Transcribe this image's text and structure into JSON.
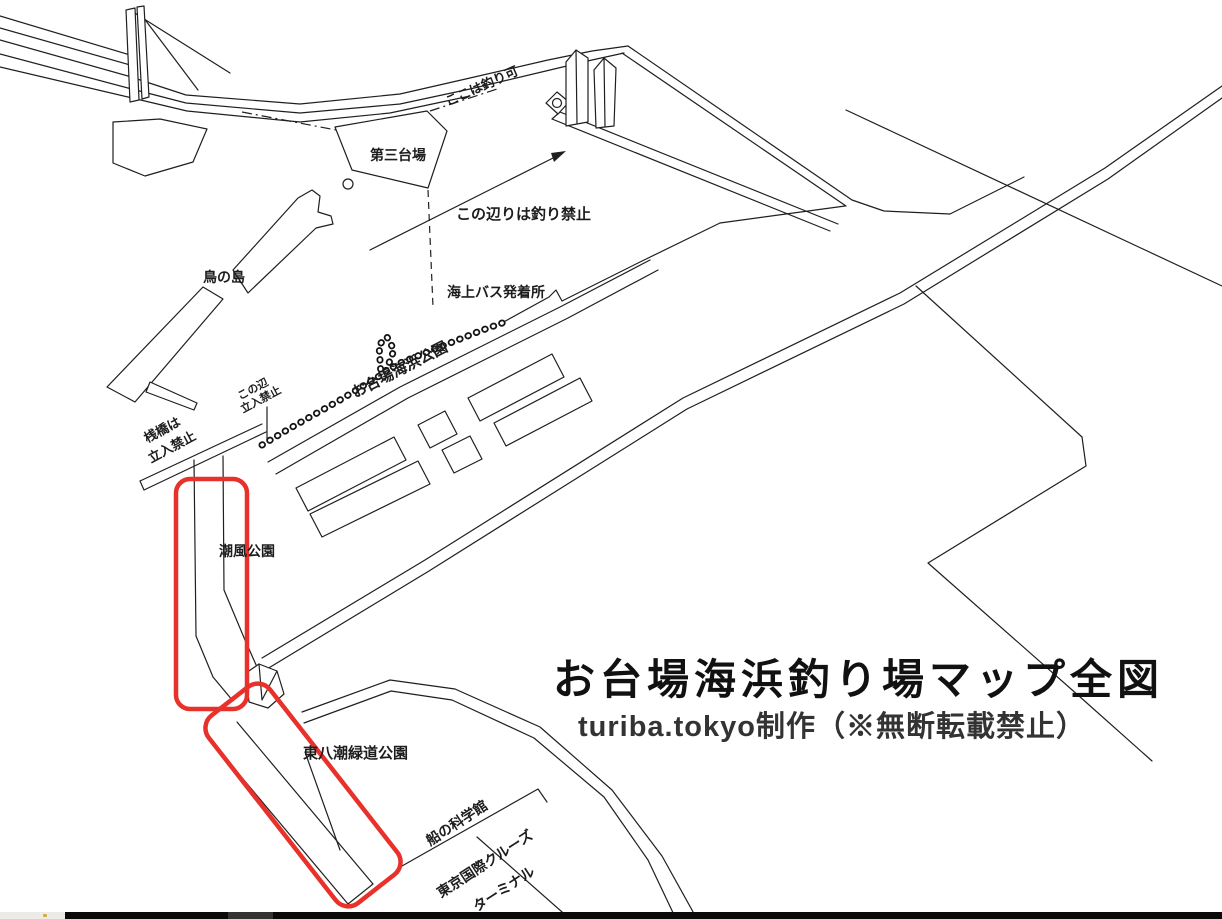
{
  "map": {
    "title": "お台場海浜釣り場マップ全図",
    "subtitle": "turiba.tokyo制作（※無断転載禁止）",
    "labels": {
      "fishing_ok": "ここは釣り可",
      "daisan_daiba": "第三台場",
      "no_fishing_area": "この辺りは釣り禁止",
      "sea_bus_terminal": "海上バス発着所",
      "tori_no_shima": "鳥の島",
      "odaiba_kaihin_koen": "お台場海浜公園",
      "kono_hen_line1": "この辺",
      "kono_hen_line2": "立入禁止",
      "sanbashi_line1": "桟橋は",
      "sanbashi_line2": "立入禁止",
      "shiokaze_koen": "潮風公園",
      "higashi_yashio_park": "東八潮緑道公園",
      "fune_no_kagakukan": "船の科学館",
      "cruise_terminal_line1": "東京国際クルーズ",
      "cruise_terminal_line2": "ターミナル"
    },
    "colors": {
      "line": "#1f1f1f",
      "highlight_red": "#e8312a",
      "background": "#ffffff"
    }
  }
}
